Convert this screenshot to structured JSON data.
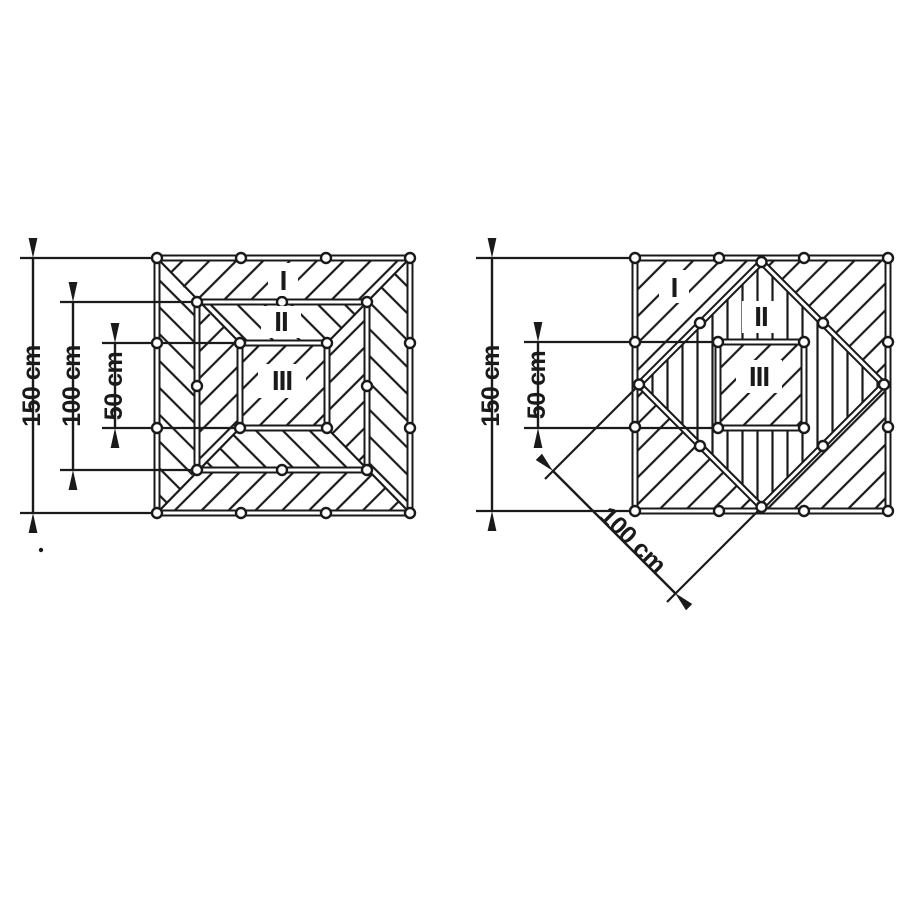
{
  "figure": {
    "background_color": "#ffffff",
    "ink_color": "#1a1a1a",
    "left_diagram": {
      "zones": {
        "i": "I",
        "ii": "II",
        "iii": "III"
      },
      "dims": {
        "d150": "150 cm",
        "d100": "100 cm",
        "d50": "50 cm"
      }
    },
    "right_diagram": {
      "zones": {
        "i": "I",
        "ii": "II",
        "iii": "III"
      },
      "dims": {
        "d150": "150 cm",
        "d50": "50 cm",
        "d100": "100 cm"
      }
    }
  }
}
